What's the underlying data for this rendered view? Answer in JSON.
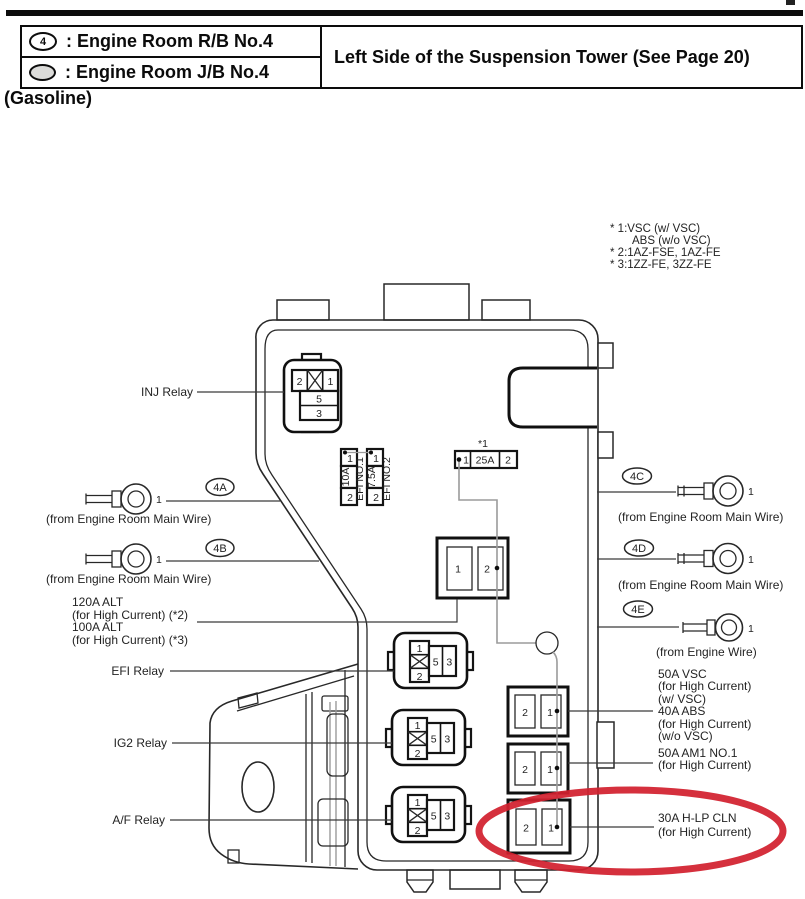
{
  "legend": {
    "rows": [
      {
        "icon": "4",
        "label": ": Engine Room R/B No.4"
      },
      {
        "label": ": Engine Room J/B No.4"
      }
    ],
    "location": "Left Side of the Suspension Tower (See Page 20)",
    "fuel_type": "(Gasoline)"
  },
  "notes": {
    "line1": "* 1:VSC (w/ VSC)",
    "line2": "ABS (w/o VSC)",
    "line3": "* 2:1AZ-FSE, 1AZ-FE",
    "line4": "* 3:1ZZ-FE, 3ZZ-FE"
  },
  "relays": {
    "inj": {
      "label": "INJ Relay",
      "pin1": "1",
      "pin2": "2",
      "pin5": "5",
      "pin3": "3"
    },
    "efi": {
      "label": "EFI Relay",
      "pin1": "1",
      "pin2": "2",
      "pin5": "5",
      "pin3": "3"
    },
    "ig2": {
      "label": "IG2 Relay",
      "pin1": "1",
      "pin2": "2",
      "pin5": "5",
      "pin3": "3"
    },
    "af": {
      "label": "A/F Relay",
      "pin1": "1",
      "pin2": "2",
      "pin5": "5",
      "pin3": "3"
    }
  },
  "fuses": {
    "efi_no1": {
      "pin_top": "1",
      "amp": "10A",
      "pin_bottom": "2",
      "name": "EFI NO.1"
    },
    "efi_no2": {
      "pin_top": "1",
      "amp": "7.5A",
      "pin_bottom": "2",
      "name": "EFI NO.2"
    },
    "main": {
      "note": "*1",
      "pin_left": "1",
      "amp": "25A",
      "pin_right": "2"
    },
    "mid_block": {
      "cell1": "1",
      "cell2": "2"
    },
    "block1": {
      "cell2": "2",
      "cell1": "1"
    },
    "block2": {
      "cell2": "2",
      "cell1": "1"
    },
    "block3": {
      "cell2": "2",
      "cell1": "1"
    }
  },
  "connectors": {
    "a": {
      "tag": "4A",
      "pin": "1",
      "caption": "(from Engine Room Main Wire)"
    },
    "b": {
      "tag": "4B",
      "pin": "1",
      "caption": "(from Engine Room Main Wire)"
    },
    "c": {
      "tag": "4C",
      "pin": "1",
      "caption": "(from Engine Room Main Wire)"
    },
    "d": {
      "tag": "4D",
      "pin": "1",
      "caption": "(from Engine Room Main Wire)"
    },
    "e": {
      "tag": "4E",
      "pin": "1",
      "caption": "(from Engine Wire)"
    }
  },
  "labels": {
    "alt": [
      "120A ALT",
      "(for High Current) (*2)",
      "100A ALT",
      "(for High Current) (*3)"
    ],
    "vsc": [
      "50A VSC",
      "(for High Current)",
      "(w/ VSC)",
      "40A ABS",
      "(for High Current)",
      "(w/o VSC)",
      "50A AM1 NO.1",
      "(for High Current)"
    ],
    "hlp": [
      "30A H-LP CLN",
      "(for High Current)"
    ]
  },
  "colors": {
    "highlight": "#d2202e"
  }
}
